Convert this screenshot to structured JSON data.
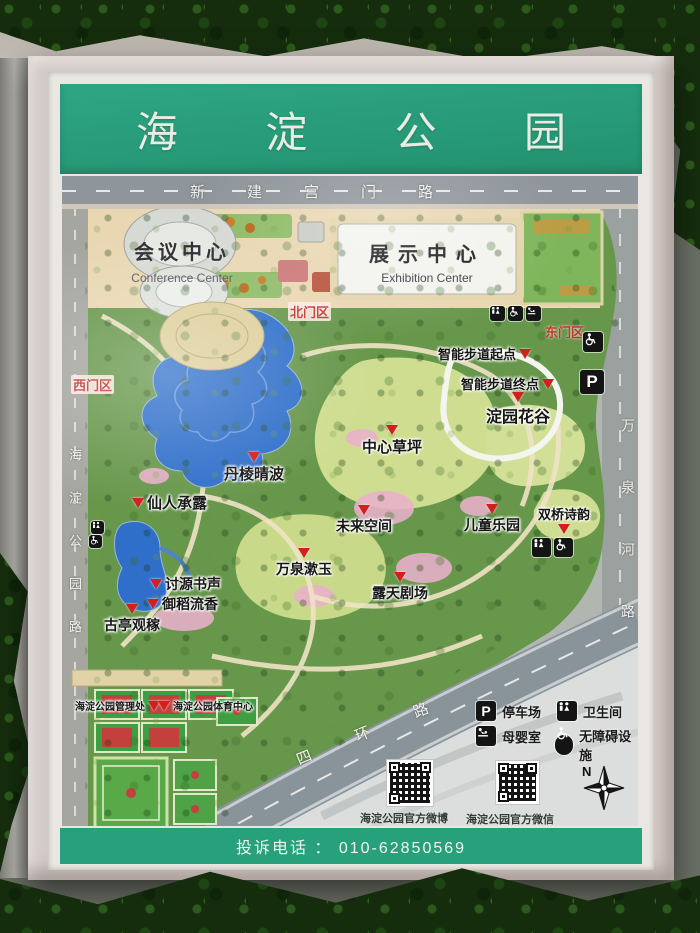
{
  "sign": {
    "title": [
      "海",
      "淀",
      "公",
      "园"
    ],
    "footer": "投诉电话 ： 010-62850569"
  },
  "map": {
    "roads": {
      "top": "新建宫门路",
      "left": "海淀公园路",
      "right": "万泉河路",
      "highway": "四环路"
    },
    "buildings": {
      "conference_cn": "会议中心",
      "conference_en": "Conference Center",
      "exhibition_cn": "展示中心",
      "exhibition_en": "Exhibition Center"
    },
    "gates": [
      {
        "label": "北门区"
      },
      {
        "label": "东门区"
      },
      {
        "label": "西门区"
      }
    ],
    "pois": [
      {
        "label": "智能步道起点"
      },
      {
        "label": "智能步道终点"
      },
      {
        "label": "淀园花谷"
      },
      {
        "label": "中心草坪"
      },
      {
        "label": "丹棱晴波"
      },
      {
        "label": "仙人承露"
      },
      {
        "label": "未来空间"
      },
      {
        "label": "儿童乐园"
      },
      {
        "label": "双桥诗韵"
      },
      {
        "label": "万泉漱玉"
      },
      {
        "label": "露天剧场"
      },
      {
        "label": "讨源书声"
      },
      {
        "label": "御稻流香"
      },
      {
        "label": "古亭观稼"
      },
      {
        "label": "海淀公园管理处"
      },
      {
        "label": "海淀公园体育中心"
      }
    ],
    "legend": [
      {
        "name": "parking",
        "label": "停车场",
        "glyph": "P"
      },
      {
        "name": "toilet",
        "label": "卫生间"
      },
      {
        "name": "baby-care",
        "label": "母婴室"
      },
      {
        "name": "accessible",
        "label": "无障碍设施"
      }
    ],
    "qr": [
      {
        "label": "海淀公园官方微博"
      },
      {
        "label": "海淀公园官方微信"
      }
    ],
    "compass": {
      "label": "N"
    }
  },
  "colors": {
    "header_green": "#2aa17d",
    "park_green": "#67974b",
    "lake_blue": "#2f6fca",
    "marker_red": "#d21f1f"
  }
}
